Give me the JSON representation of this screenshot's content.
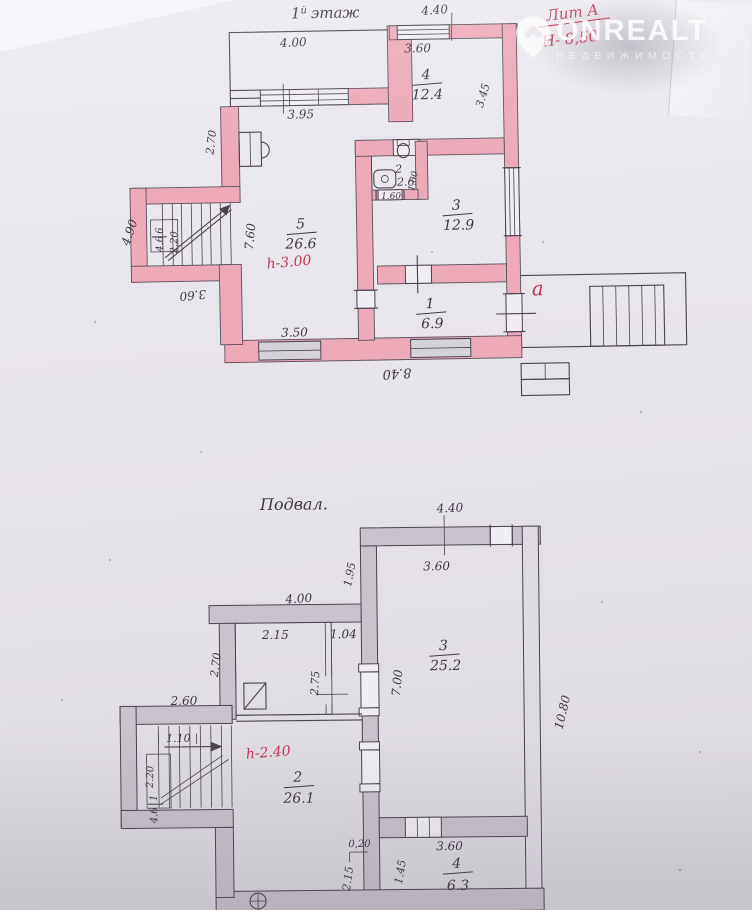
{
  "watermark": {
    "brand": "ONREALT",
    "tagline": "НЕДВИЖИМОСТЬ"
  },
  "floor1": {
    "title_num": "1",
    "title_sup": "й",
    "title_word": "этаж",
    "lit": "Лит А",
    "height": "Н- 8,50",
    "ceiling": "h-3.00",
    "porch": "а",
    "dim_top": "4.40",
    "veranda_top": "4.00",
    "veranda_window": "3.95",
    "veranda_side": "2.70",
    "room4": {
      "num": "4",
      "area": "12.4",
      "top": "3.60",
      "side": "3.45"
    },
    "bath": {
      "num": "2",
      "area": "2.6",
      "width": "1.60",
      "depth": "1.60"
    },
    "room3": {
      "num": "3",
      "area": "12.9"
    },
    "room5": {
      "num": "5",
      "area": "26.6",
      "depth": "7.60"
    },
    "stairs": {
      "num": "6",
      "area": "4.6",
      "width": "2.20",
      "side": "4.90",
      "bottom": "3.60"
    },
    "room1": {
      "num": "1",
      "area": "6.9"
    },
    "dim_bottom": "3.50",
    "dim_total": "8.40"
  },
  "basement": {
    "title": "Подвал.",
    "ceiling": "h-2.40",
    "dim_top": "4.40",
    "offset": "1.95",
    "left_top": "4.00",
    "furnace": {
      "w1": "2.15",
      "w2": "1.04",
      "depth": "2.75",
      "side": "2.70"
    },
    "room3": {
      "num": "3",
      "area": "25.2",
      "top": "3.60",
      "depth": "7.00",
      "side": "10.80"
    },
    "stairs": {
      "top": "2.60",
      "width": "1.10",
      "depth": "2.20",
      "num": "1",
      "area": "4.6"
    },
    "room2": {
      "num": "2",
      "area": "26.1"
    },
    "notch": "0,20",
    "corridor": "2.15",
    "room4": {
      "num": "4",
      "area": "6.3",
      "top": "3.60",
      "side": "1.45"
    }
  }
}
